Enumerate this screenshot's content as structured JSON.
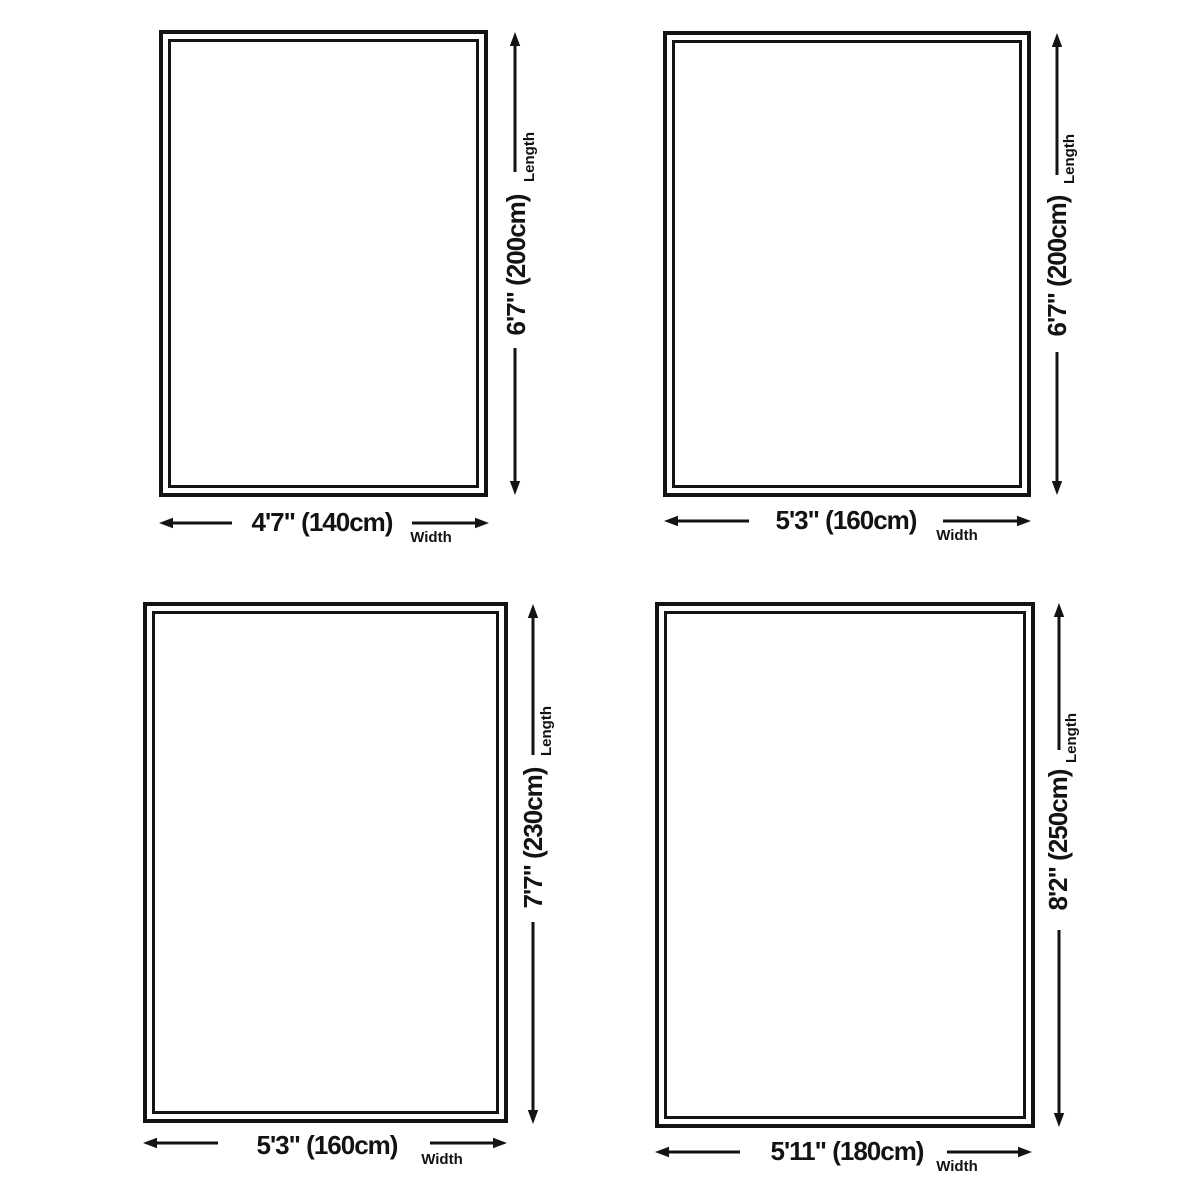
{
  "diagram": {
    "background": "#ffffff",
    "ink": "#131313",
    "length_label": "Length",
    "width_label": "Width",
    "panels": [
      {
        "position": "top-left",
        "width": "4'7\" (140cm)",
        "length": "6'7\" (200cm)"
      },
      {
        "position": "top-right",
        "width": "5'3\" (160cm)",
        "length": "6'7\" (200cm)"
      },
      {
        "position": "bottom-left",
        "width": "5'3\" (160cm)",
        "length": "7'7\" (230cm)"
      },
      {
        "position": "bottom-right",
        "width": "5'11\" (180cm)",
        "length": "8'2\" (250cm)"
      }
    ]
  }
}
